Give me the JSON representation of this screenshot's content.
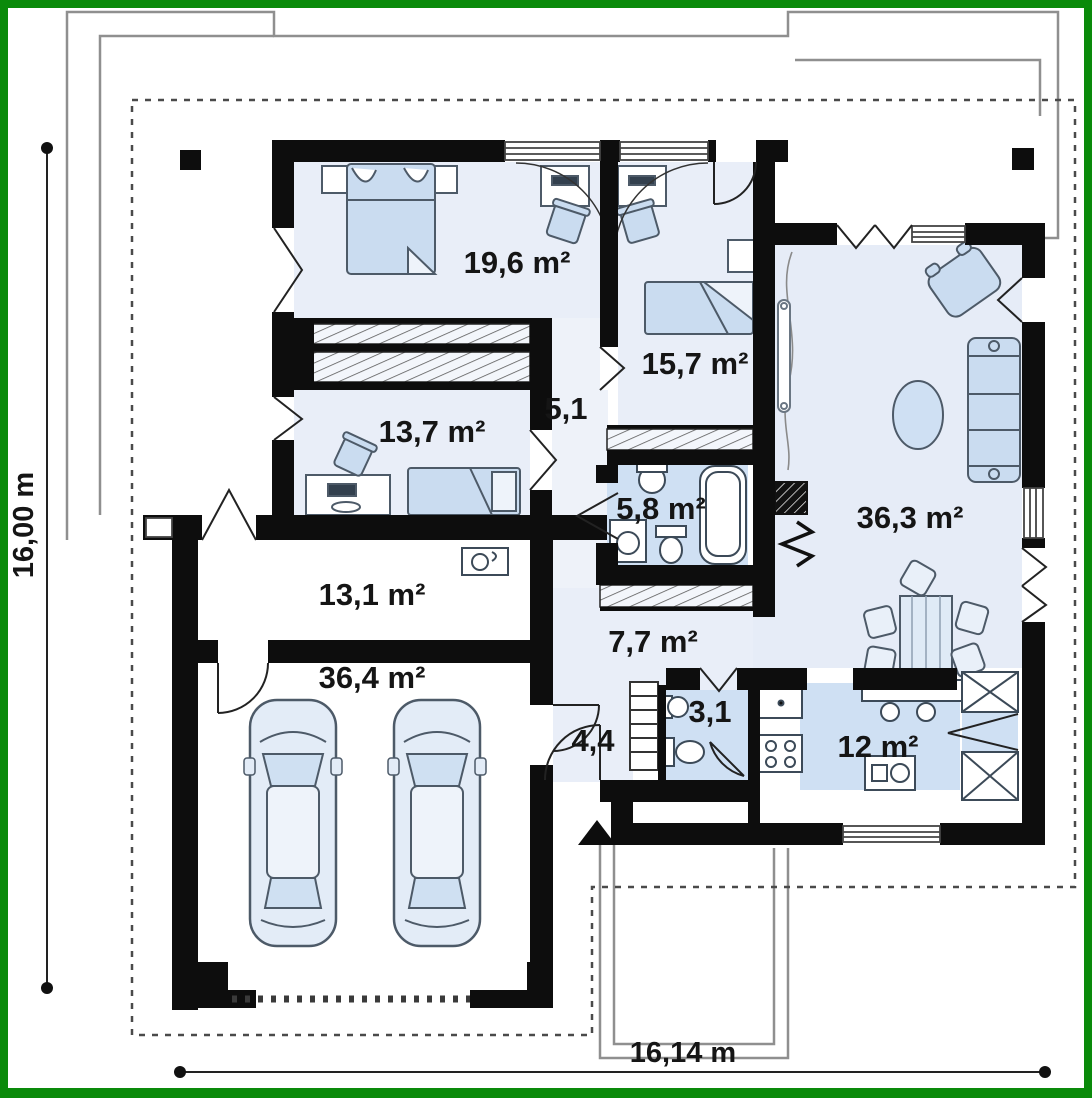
{
  "plan": {
    "type": "single-storey house floor plan",
    "frame_color": "#0a8a0a",
    "wall_color": "#0d0d0d",
    "floor_tint": "#e9eef8",
    "floor_blue": "#cfe0f3",
    "furniture_fill": "#cadcf0",
    "contour_gray": "#8f8f8f"
  },
  "dimensions": {
    "left_label": "16,00 m",
    "bottom_label": "16,14 m"
  },
  "rooms": [
    {
      "id": "bedroom-1",
      "label": "19,6 m²"
    },
    {
      "id": "bedroom-2",
      "label": "15,7 m²"
    },
    {
      "id": "bedroom-3",
      "label": "13,7 m²"
    },
    {
      "id": "corridor",
      "label": "5,1"
    },
    {
      "id": "bathroom",
      "label": "5,8 m²"
    },
    {
      "id": "living-room",
      "label": "36,3 m²"
    },
    {
      "id": "utility",
      "label": "13,1 m²"
    },
    {
      "id": "hall",
      "label": "7,7 m²"
    },
    {
      "id": "garage",
      "label": "36,4 m²"
    },
    {
      "id": "vestibule",
      "label": "4,4"
    },
    {
      "id": "wc",
      "label": "3,1"
    },
    {
      "id": "kitchen",
      "label": "12 m²"
    }
  ]
}
